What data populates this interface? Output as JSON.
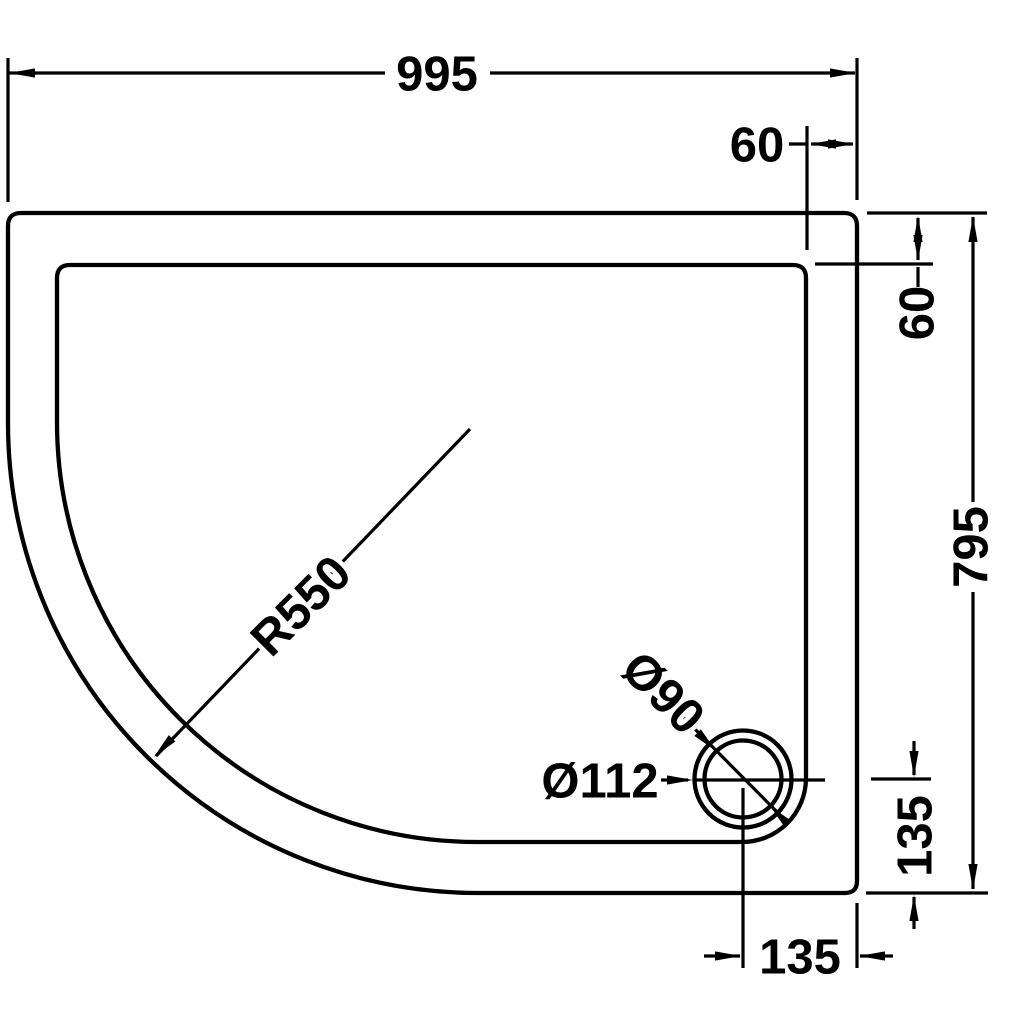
{
  "drawing": {
    "background_color": "#ffffff",
    "line_color": "#000000",
    "dimensions": {
      "width": "995",
      "top_offset": "60",
      "side_offset": "60",
      "height": "795",
      "corner_radius": "R550",
      "waste_outer_diameter": "Ø112",
      "waste_inner_diameter": "Ø90",
      "waste_center_to_bottom": "135",
      "waste_center_to_side": "135"
    }
  }
}
